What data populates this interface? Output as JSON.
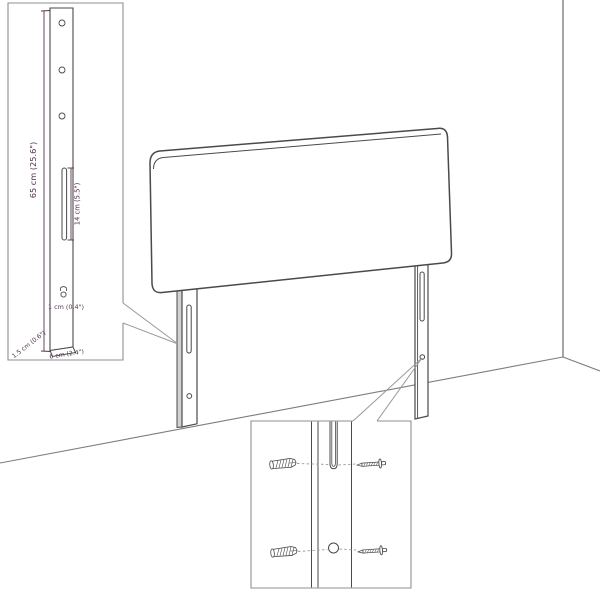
{
  "diagram": {
    "measurements": {
      "leg_height": "65 cm (25.6\")",
      "slot_length": "14 cm (5.5\")",
      "hole_diameter": "1 cm (0.4\")",
      "leg_depth": "1.5 cm (0.6\")",
      "leg_width": "6 cm (2.4\")"
    },
    "colors": {
      "outline": "#4a4a4a",
      "wall_line": "#8f8f8f",
      "dimension": "#53344e",
      "leader_line": "#9a9a9a",
      "shade": "#d2d2d2",
      "background": "#ffffff"
    }
  }
}
